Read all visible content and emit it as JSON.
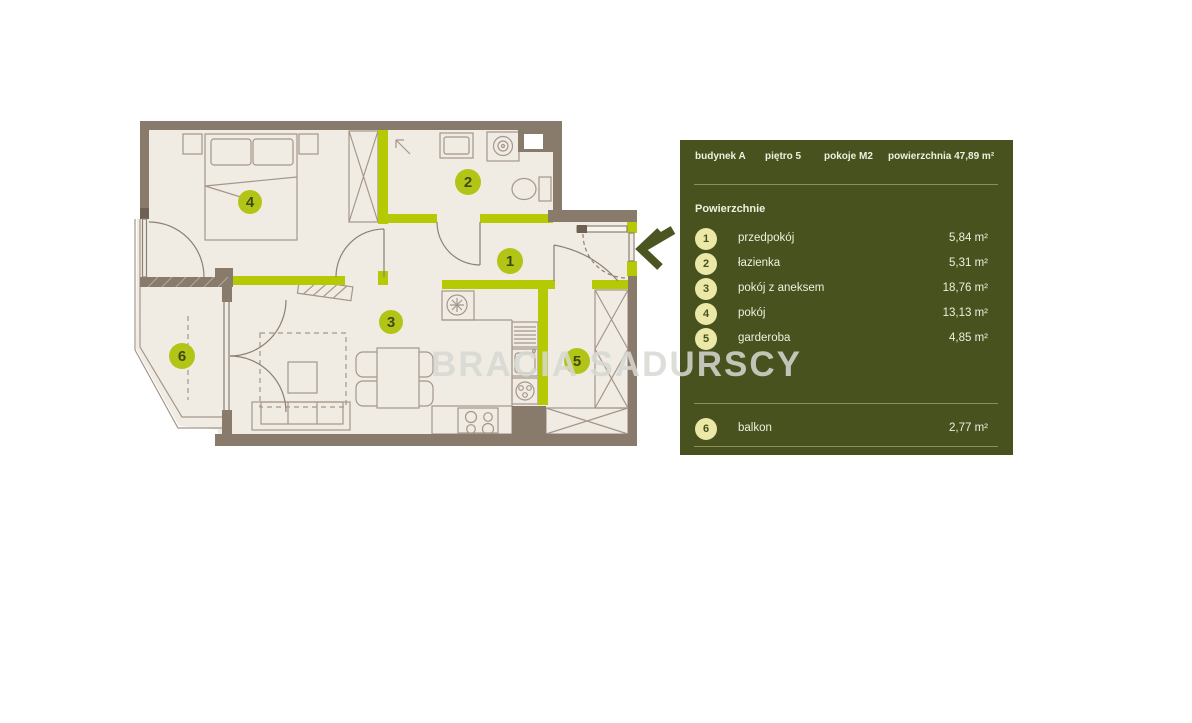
{
  "watermark": "BRACIA SADURSCY",
  "unit": {
    "building_label": "budynek A",
    "floor_label": "piętro  5",
    "rooms_label": "pokoje  M2",
    "area_label": "powierzchnia 47,89 m²"
  },
  "panel": {
    "section_title": "Powierzchnie"
  },
  "rooms": [
    {
      "num": "1",
      "label": "przedpokój",
      "area": "5,84 m²"
    },
    {
      "num": "2",
      "label": "łazienka",
      "area": "5,31 m²"
    },
    {
      "num": "3",
      "label": "pokój z aneksem",
      "area": "18,76 m²"
    },
    {
      "num": "4",
      "label": "pokój",
      "area": "13,13 m²"
    },
    {
      "num": "5",
      "label": "garderoba",
      "area": "4,85 m²"
    },
    {
      "num": "6",
      "label": "balkon",
      "area": "2,77 m²"
    }
  ],
  "colors": {
    "panel_bg": "#47521f",
    "accent_green": "#b6c905",
    "wall_brown": "#897b6c",
    "floor_beige": "#f0ece3",
    "plan_circle": "#b2c516",
    "panel_circle": "#ebe8a8",
    "watermark_gray": "#d8d9d3"
  }
}
